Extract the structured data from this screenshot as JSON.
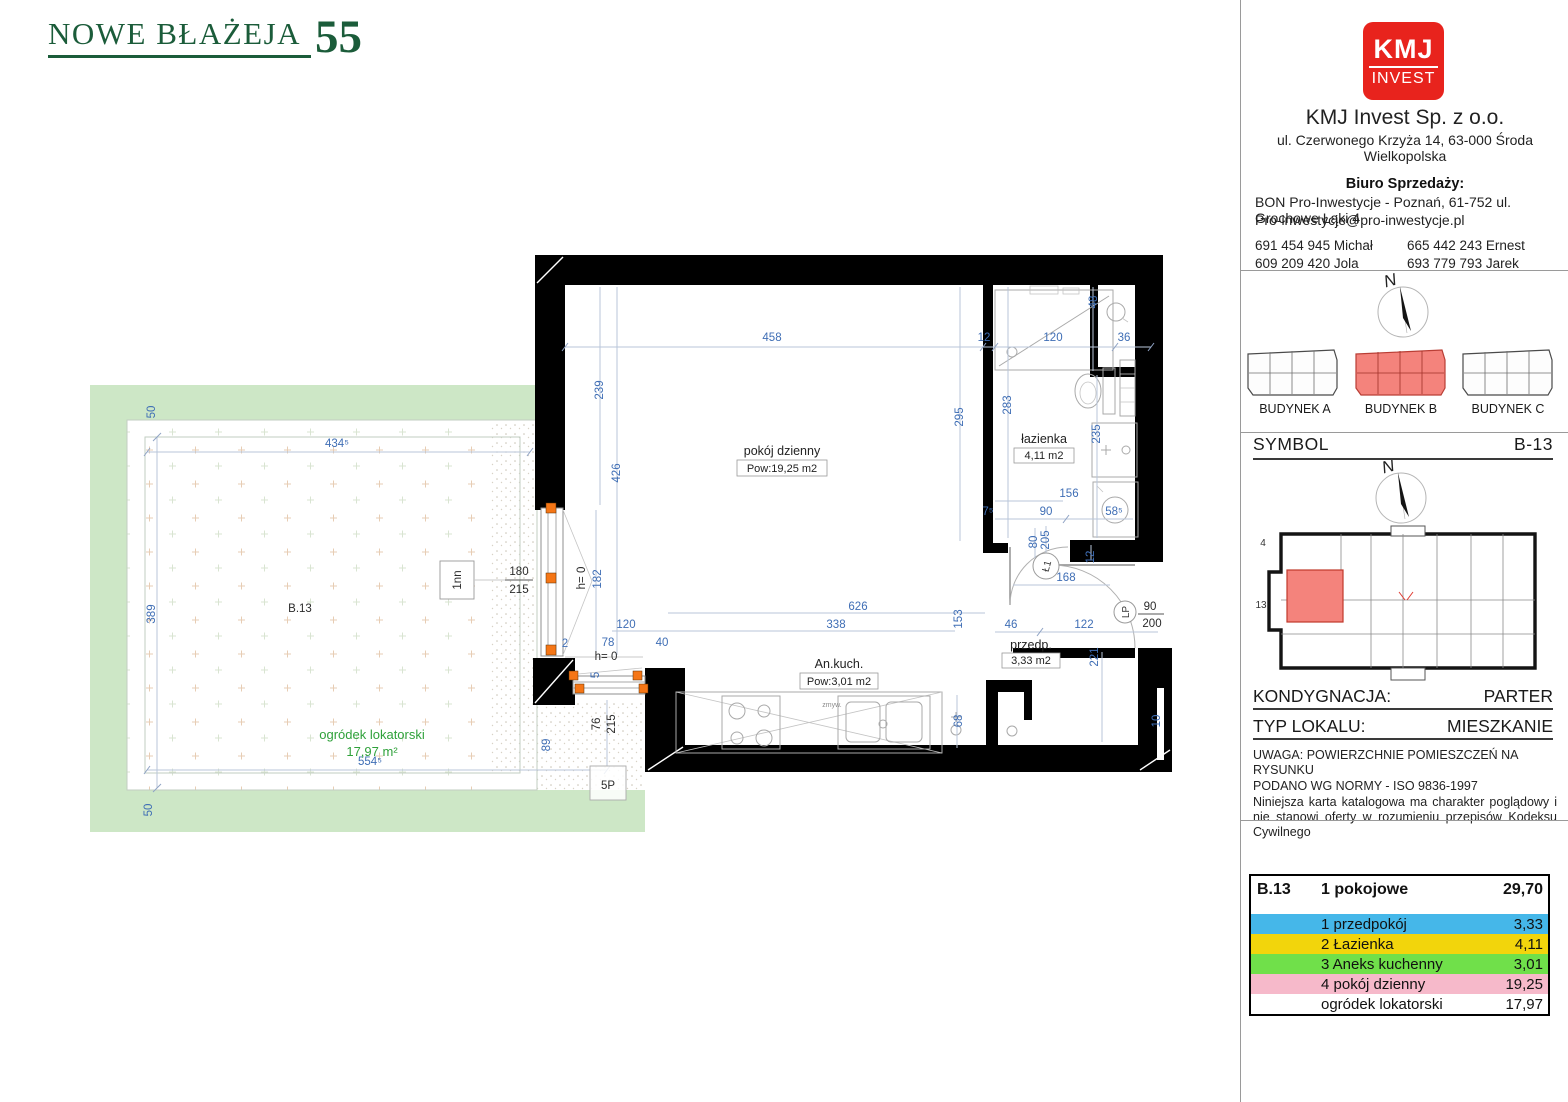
{
  "brand": {
    "name": "NOWE BŁAŻEJA",
    "number": "55"
  },
  "company": {
    "logo_top": "KMJ",
    "logo_bottom": "INVEST",
    "name": "KMJ Invest Sp. z o.o.",
    "address": "ul. Czerwonego Krzyża 14, 63-000 Środa Wielkopolska",
    "sales_label": "Biuro Sprzedaży:",
    "sales_line1": "BON Pro-Inwestycje - Poznań, 61-752 ul. Grochowe Łąki 4",
    "sales_line2": "Pro-inwestycje@pro-inwestycje.pl",
    "phones": [
      "691 454 945 Michał",
      "665 442 243 Ernest",
      "609 209 420 Jola",
      "693 779 793 Jarek"
    ]
  },
  "compass": {
    "letter": "N"
  },
  "buildings": {
    "a": "BUDYNEK A",
    "b": "BUDYNEK B",
    "c": "BUDYNEK C"
  },
  "symbol": {
    "label": "SYMBOL",
    "value": "B-13"
  },
  "miniplan": {
    "top_label": "4",
    "left_label": "13"
  },
  "floor": {
    "label": "KONDYGNACJA:",
    "value": "PARTER"
  },
  "unit_type": {
    "label": "TYP LOKALU:",
    "value": "MIESZKANIE"
  },
  "uwaga": {
    "line1": "UWAGA: POWIERZCHNIE POMIESZCZEŃ NA RYSUNKU",
    "line2": "PODANO WG NORMY - ISO 9836-1997",
    "para": "Niniejsza karta katalogowa ma charakter poglądowy i nie stanowi oferty w rozumieniu przepisów Kodeksu Cywilnego"
  },
  "table": {
    "unit_id": "B.13",
    "unit_kind": "1 pokojowe",
    "total": "29,70",
    "rows": [
      {
        "name": "1 przedpokój",
        "value": "3,33",
        "color": "#45b7e9"
      },
      {
        "name": "2 Łazienka",
        "value": "4,11",
        "color": "#f2d50c"
      },
      {
        "name": "3 Aneks kuchenny",
        "value": "3,01",
        "color": "#70e04a"
      },
      {
        "name": "4 pokój dzienny",
        "value": "19,25",
        "color": "#f6b9ca"
      },
      {
        "name": "ogródek lokatorski",
        "value": "17,97",
        "color": "#ffffff"
      }
    ]
  },
  "plan": {
    "rooms": {
      "living_name": "pokój dzienny",
      "living_area": "Pow:19,25 m2",
      "bath_name": "łazienka",
      "bath_area": "4,11 m2",
      "kitchen_name": "An.kuch.",
      "kitchen_area": "Pow:3,01 m2",
      "hall_name": "przedp.",
      "hall_area": "3,33 m2",
      "garden_name": "ogródek lokatorski",
      "garden_area": "17,97 m²"
    },
    "markers": {
      "l1": "Ł1",
      "lp": "LP",
      "zmyw": "zmyw."
    },
    "dims": {
      "top_458": "458",
      "top_12": "12",
      "bath_120": "120",
      "bath_36": "36",
      "bath_48": "48",
      "left_239": "239",
      "left_426": "426",
      "right_295": "295",
      "bath_283": "283",
      "bath_235": "235",
      "bath_156": "156",
      "bath_90": "90",
      "bath_58s": "58⁵",
      "bath_7s": "7⁵",
      "hall_80": "80",
      "hall_205": "205",
      "hall_12": "12",
      "hall_168": "168",
      "hall_46": "46",
      "hall_122": "122",
      "hall_221": "221",
      "kit_626": "626",
      "kit_338": "338",
      "kit_153": "153",
      "kit_120": "120",
      "kit_78": "78",
      "kit_40": "40",
      "kit_2": "2",
      "kit_5": "5",
      "kit_68": "68",
      "win_h0a": "h= 0",
      "win_182": "182",
      "win_h0b": "h= 0",
      "win_76": "76",
      "win_215": "215",
      "win_1nn": "1nn",
      "win_180": "180",
      "win_215b": "215",
      "right_10": "10",
      "door_90": "90",
      "door_200": "200",
      "g_50t": "50",
      "g_434s": "434⁵",
      "g_389": "389",
      "g_554s": "554⁵",
      "g_50b": "50",
      "g_89": "89",
      "g_b13": "B.13",
      "g_5p": "5P"
    }
  },
  "colors": {
    "dim_blue": "#3f6eb5",
    "wall_black": "#000000",
    "garden_band": "#cde7c6",
    "garden_text": "#2fa13a",
    "window_orange": "#f57616",
    "brand_green": "#1b5c3a",
    "kmj_red": "#e8231d",
    "highlight_red": "#f4837c"
  }
}
